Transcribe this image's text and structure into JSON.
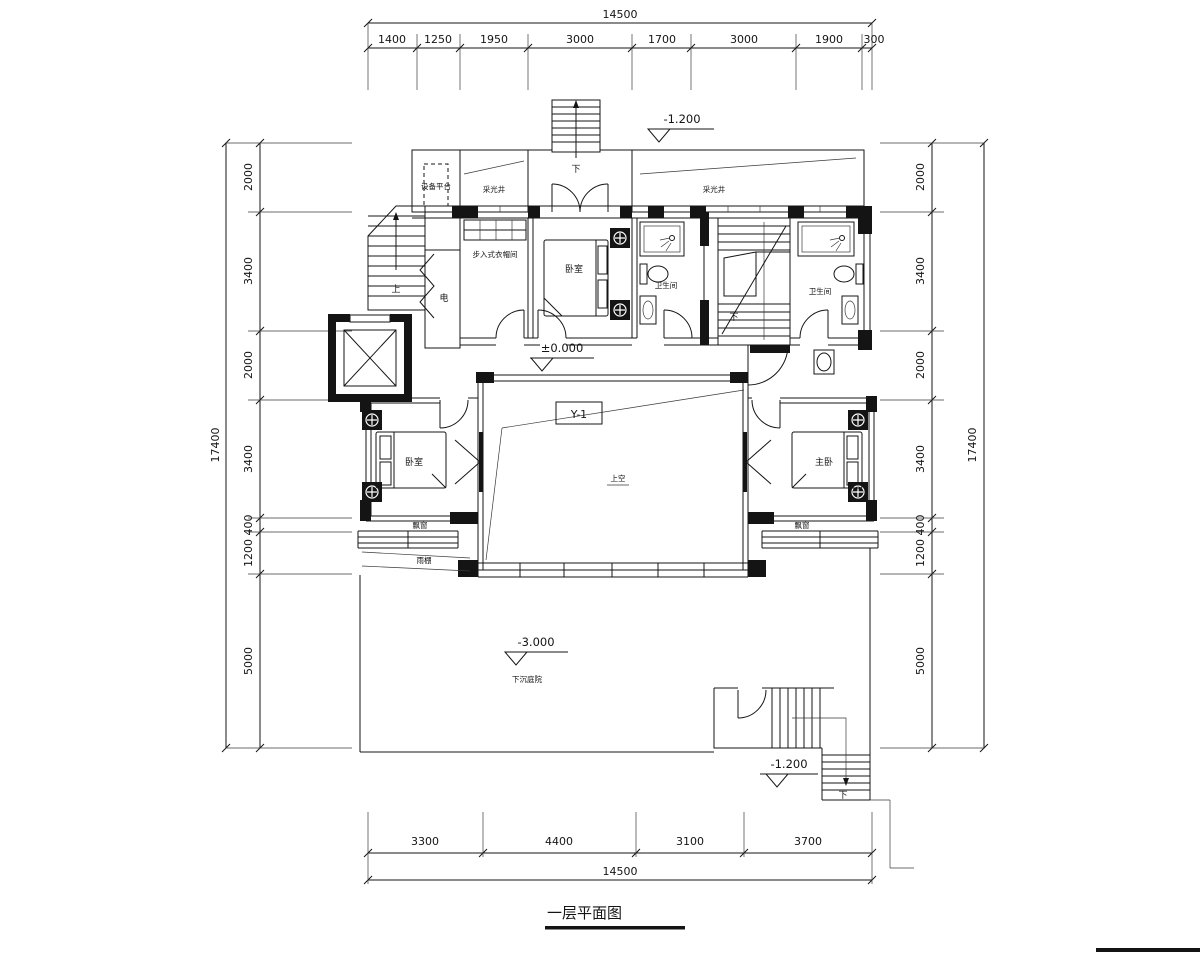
{
  "title": "一层平面图",
  "dimensions": {
    "top": {
      "total": "14500",
      "segments": [
        "1400",
        "1250",
        "1950",
        "3000",
        "1700",
        "3000",
        "1900",
        "300"
      ]
    },
    "bottom": {
      "total": "14500",
      "segments": [
        "3300",
        "4400",
        "3100",
        "3700"
      ]
    },
    "left": {
      "total": "17400",
      "segments": [
        "2000",
        "3400",
        "2000",
        "3400",
        "400",
        "1200",
        "5000"
      ]
    },
    "right": {
      "total": "17400",
      "segments": [
        "2000",
        "3400",
        "2000",
        "3400",
        "400",
        "1200",
        "5000"
      ]
    }
  },
  "levels": {
    "top_entry": "-1.200",
    "indoor": "±0.000",
    "courtyard": "-3.000",
    "courtyard_stair": "-1.200"
  },
  "rooms": {
    "equipment_platform": "设备平台",
    "light_well_left": "采光井",
    "light_well_right": "采光井",
    "walk_in_closet": "步入式衣帽间",
    "bedroom_top": "卧室",
    "bathroom_left": "卫生间",
    "bathroom_right": "卫生间",
    "elec_shaft": "电",
    "bedroom_left": "卧室",
    "master_bedroom": "主卧",
    "bay_window_left": "飘窗",
    "bay_window_right": "飘窗",
    "canopy": "雨棚",
    "void_above": "上空",
    "sunken_courtyard": "下沉庭院"
  },
  "stairs": {
    "up": "上",
    "down_top": "下",
    "down_center": "下",
    "down_courtyard": "下"
  },
  "annotations": {
    "y1": "Y-1"
  },
  "colors": {
    "line": "#141414",
    "wall_fill": "#141414",
    "background": "#ffffff"
  }
}
